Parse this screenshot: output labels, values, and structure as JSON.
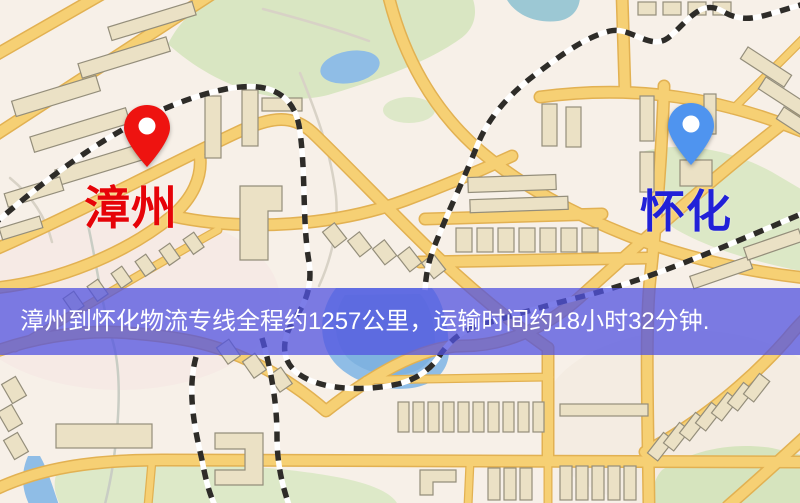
{
  "map": {
    "origin": {
      "name": "漳州",
      "pin_color": "#ee1310",
      "label_color": "#e60308"
    },
    "destination": {
      "name": "怀化",
      "pin_color": "#4f94ef",
      "label_color": "#2121d8"
    },
    "colors": {
      "background": "#f7f0e8",
      "road_fill": "#f6d074",
      "road_casing": "#e2b152",
      "building": "#ebe1c5",
      "building_outline": "#948e7b",
      "park_green": "#d9e6c2",
      "water_blue": "#8fbde6",
      "railway": "#2e2c28"
    }
  },
  "banner": {
    "text": "漳州到怀化物流专线全程约1257公里，运输时间约18小时32分钟.",
    "background_color": "rgba(82,83,224,0.75)",
    "text_color": "#ffffff",
    "route": {
      "origin": "漳州",
      "destination": "怀化",
      "distance_km": 1257,
      "duration_hours": 18,
      "duration_minutes": 32
    }
  }
}
